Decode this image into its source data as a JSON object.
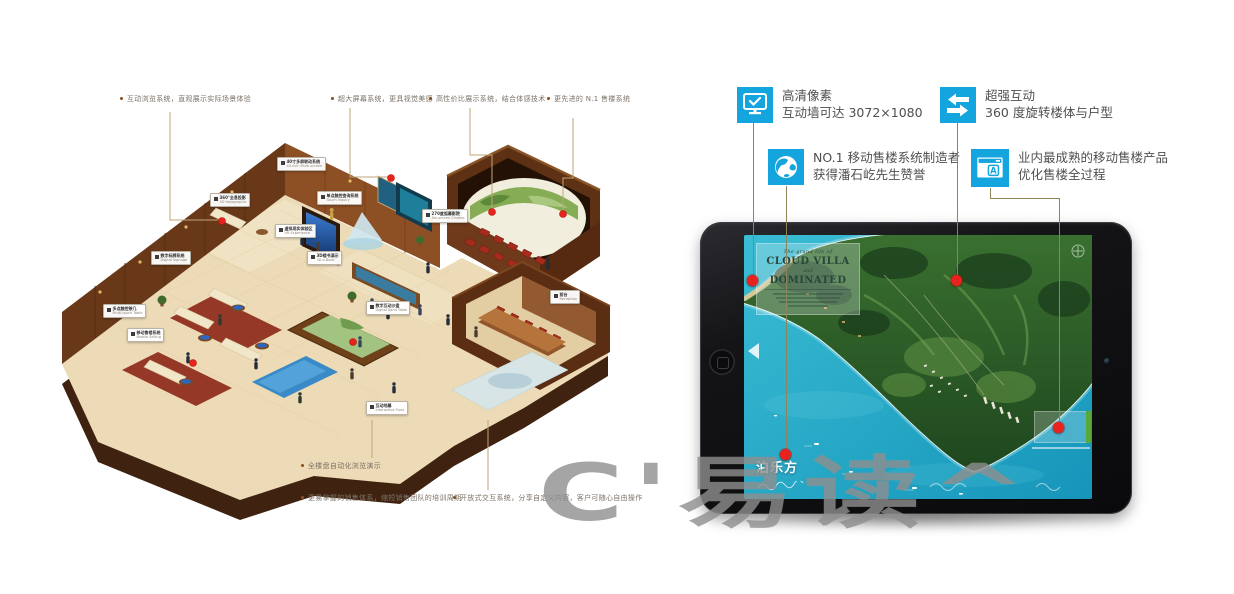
{
  "colors": {
    "accent_blue": "#14a5de",
    "dot_red": "#e8231d",
    "connector_olive": "#8c845a",
    "connector_tan": "#bfa577",
    "watermark_gray": "#8f8f8f"
  },
  "left_panel": {
    "labels_top": [
      {
        "text": "互动浏览系统，直观展示实际场景体验"
      },
      {
        "text": "超大屏幕系统，更具视觉美感"
      },
      {
        "text": "高性价比展示系统，结合体感技术"
      },
      {
        "text": "更先进的 N.1 售楼系统"
      }
    ],
    "labels_bottom": [
      {
        "text": "全楼盘自动化浏览演示"
      },
      {
        "text": "更易掌握的销售体系，缩短销售团队的培训周期"
      },
      {
        "text": "开放式交互系统，分享自定义内容，客户可随心自由操作"
      }
    ],
    "scene_tags": [
      {
        "zh": "40寸多屏联动系统",
        "en": "40-inch Multi-screen"
      },
      {
        "zh": "360°全息投影",
        "en": "3D Holographic"
      },
      {
        "zh": "单点触控查询系统",
        "en": "Touch Inquiry"
      },
      {
        "zh": "虚拟现实体验区",
        "en": "VR Experience"
      },
      {
        "zh": "3D楼书演示",
        "en": "3D e-Book"
      },
      {
        "zh": "270度弧幕影院",
        "en": "Arc-screen Cinema"
      },
      {
        "zh": "数字标牌系统",
        "en": "Digital Signage"
      },
      {
        "zh": "多点触控茶几",
        "en": "Multi-touch Table"
      },
      {
        "zh": "移动售楼系统",
        "en": "Mobile Selling"
      },
      {
        "zh": "数字互动沙盘",
        "en": "Digital Sand Table"
      },
      {
        "zh": "前台",
        "en": "Reception"
      },
      {
        "zh": "互动地幕",
        "en": "Interactive Floor"
      }
    ]
  },
  "right_panel": {
    "features": [
      {
        "icon": "display-check-icon",
        "title": "高清像素",
        "subtitle": "互动墙可达 3072×1080"
      },
      {
        "icon": "swap-arrows-icon",
        "title": "超强互动",
        "subtitle": "360 度旋转楼体与户型"
      },
      {
        "icon": "globe-icon",
        "title": "NO.1 移动售楼系统制造者",
        "subtitle": "获得潘石屹先生赞誉"
      },
      {
        "icon": "window-translate-icon",
        "title": "业内最成熟的移动售楼产品",
        "subtitle": "优化售楼全过程"
      }
    ],
    "tablet": {
      "map_overlay": {
        "top_line": "The grand life of",
        "title_1": "CLOUD VILLA",
        "mid_line": "and",
        "title_2": "DOMINATED"
      },
      "logo_text": "泊乐方",
      "watermark": "C'易读^"
    }
  }
}
